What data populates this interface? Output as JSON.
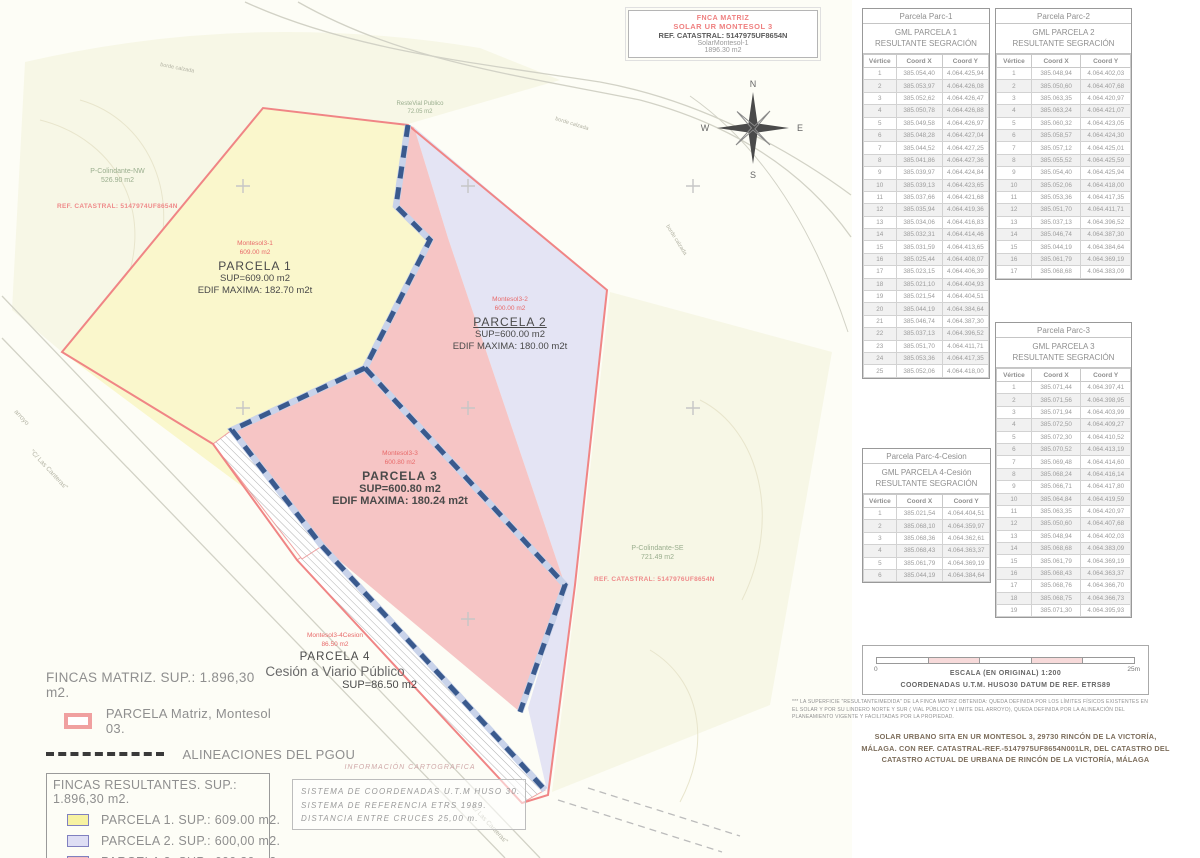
{
  "title_block": {
    "line1": "FNCA MATRIZ",
    "line2": "SOLAR UR MONTESOL 3",
    "line3": "REF. CATASTRAL: 5147975UF8654N",
    "line4": "SolarMontesol-1",
    "line5": "1896.30 m2"
  },
  "compass": {
    "n": "N",
    "s": "S",
    "e": "E",
    "w": "W"
  },
  "map_labels": {
    "colindante_nw": {
      "name": "P-Colindante-NW",
      "area": "526.90 m2",
      "ref": "REF. CATASTRAL: 5147974UF8654N"
    },
    "colindante_se": {
      "name": "P-Colindante-SE",
      "area": "721.49 m2",
      "ref": "REF. CATASTRAL: 5147976UF8654N"
    },
    "reste_vial": {
      "name": "ResteVial Publico",
      "area": "72.05 m2"
    },
    "parcela1": {
      "tag": "Montesol3-1",
      "tag_area": "609.00 m2",
      "title": "PARCELA 1",
      "sup": "SUP=609.00 m2",
      "edif": "EDIF MAXIMA: 182.70 m2t"
    },
    "parcela2": {
      "tag": "Montesol3-2",
      "tag_area": "600.00 m2",
      "title": "PARCELA 2",
      "sup": "SUP=600.00 m2",
      "edif": "EDIF MAXIMA: 180.00 m2t"
    },
    "parcela3": {
      "tag": "Montesol3-3",
      "tag_area": "600.80 m2",
      "title": "PARCELA 3",
      "sup": "SUP=600.80 m2",
      "edif": "EDIF MAXIMA: 180.24 m2t"
    },
    "parcela4": {
      "tag": "Montesol3-4Cesion",
      "tag_area": "86.50 m2",
      "title": "PARCELA 4",
      "subtitle": "Cesión a Viario Público",
      "sup": "SUP=86.50 m2"
    },
    "street_canteras": "\"C/ Las Canteras\"",
    "street_arroyo": "arroyo",
    "road_edge": "borde calzada"
  },
  "legend": {
    "fincas_matriz": "FINCAS MATRIZ.  SUP.: 1.896,30 m2.",
    "parcela_matriz": "PARCELA Matriz, Montesol 03.",
    "alineaciones": "ALINEACIONES DEL PGOU",
    "fincas_resultantes": "FINCAS RESULTANTES. SUP.: 1.896,30 m2.",
    "items": [
      {
        "label": "PARCELA 1. SUP.: 609.00 m2.",
        "color": "#f7f2a2"
      },
      {
        "label": "PARCELA 2. SUP.: 600,00 m2.",
        "color": "#dedef4"
      },
      {
        "label": "PARCELA 3. SUP.: 600,80 m2.",
        "color": "#f3bcbc"
      },
      {
        "label": "CESION VIARIO. SUP.: 86.50 m2.",
        "color": "#ffffff"
      }
    ]
  },
  "cartografia": {
    "header": "INFORMACIÓN CARTOGRAFICA",
    "lines": [
      "SISTEMA DE COORDENADAS U.T.M HUSO 30.",
      "SISTEMA DE REFERENCIA ETRS 1989.",
      "DISTANCIA ENTRE CRUCES 25,00 m."
    ]
  },
  "tables": [
    {
      "title": "Parcela Parc-1",
      "subtitle1": "GML PARCELA 1",
      "subtitle2": "RESULTANTE SEGRACIÓN",
      "headers": [
        "Vértice",
        "Coord X",
        "Coord Y"
      ],
      "rows": [
        [
          "1",
          "385.054,40",
          "4.064.425,94"
        ],
        [
          "2",
          "385.053,97",
          "4.064.426,08"
        ],
        [
          "3",
          "385.052,62",
          "4.064.426,47"
        ],
        [
          "4",
          "385.050,78",
          "4.064.426,88"
        ],
        [
          "5",
          "385.049,58",
          "4.064.426,97"
        ],
        [
          "6",
          "385.048,28",
          "4.064.427,04"
        ],
        [
          "7",
          "385.044,52",
          "4.064.427,25"
        ],
        [
          "8",
          "385.041,86",
          "4.064.427,36"
        ],
        [
          "9",
          "385.039,97",
          "4.064.424,84"
        ],
        [
          "10",
          "385.039,13",
          "4.064.423,65"
        ],
        [
          "11",
          "385.037,66",
          "4.064.421,68"
        ],
        [
          "12",
          "385.035,94",
          "4.064.419,36"
        ],
        [
          "13",
          "385.034,06",
          "4.064.416,83"
        ],
        [
          "14",
          "385.032,31",
          "4.064.414,46"
        ],
        [
          "15",
          "385.031,59",
          "4.064.413,65"
        ],
        [
          "16",
          "385.025,44",
          "4.064.408,07"
        ],
        [
          "17",
          "385.023,15",
          "4.064.406,39"
        ],
        [
          "18",
          "385.021,10",
          "4.064.404,93"
        ],
        [
          "19",
          "385.021,54",
          "4.064.404,51"
        ],
        [
          "20",
          "385.044,19",
          "4.064.384,64"
        ],
        [
          "21",
          "385.046,74",
          "4.064.387,30"
        ],
        [
          "22",
          "385.037,13",
          "4.064.396,52"
        ],
        [
          "23",
          "385.051,70",
          "4.064.411,71"
        ],
        [
          "24",
          "385.053,36",
          "4.064.417,35"
        ],
        [
          "25",
          "385.052,06",
          "4.064.418,00"
        ]
      ]
    },
    {
      "title": "Parcela Parc-2",
      "subtitle1": "GML PARCELA 2",
      "subtitle2": "RESULTANTE SEGRACIÓN",
      "headers": [
        "Vértice",
        "Coord X",
        "Coord Y"
      ],
      "rows": [
        [
          "1",
          "385.048,94",
          "4.064.402,03"
        ],
        [
          "2",
          "385.050,60",
          "4.064.407,68"
        ],
        [
          "3",
          "385.063,35",
          "4.064.420,97"
        ],
        [
          "4",
          "385.063,24",
          "4.064.421,07"
        ],
        [
          "5",
          "385.060,32",
          "4.064.423,05"
        ],
        [
          "6",
          "385.058,57",
          "4.064.424,30"
        ],
        [
          "7",
          "385.057,12",
          "4.064.425,01"
        ],
        [
          "8",
          "385.055,52",
          "4.064.425,59"
        ],
        [
          "9",
          "385.054,40",
          "4.064.425,94"
        ],
        [
          "10",
          "385.052,06",
          "4.064.418,00"
        ],
        [
          "11",
          "385.053,36",
          "4.064.417,35"
        ],
        [
          "12",
          "385.051,70",
          "4.064.411,71"
        ],
        [
          "13",
          "385.037,13",
          "4.064.396,52"
        ],
        [
          "14",
          "385.046,74",
          "4.064.387,30"
        ],
        [
          "15",
          "385.044,19",
          "4.064.384,64"
        ],
        [
          "16",
          "385.061,79",
          "4.064.369,19"
        ],
        [
          "17",
          "385.068,68",
          "4.064.383,09"
        ]
      ]
    },
    {
      "title": "Parcela Parc-3",
      "subtitle1": "GML PARCELA 3",
      "subtitle2": "RESULTANTE SEGRACIÓN",
      "headers": [
        "Vértice",
        "Coord X",
        "Coord Y"
      ],
      "rows": [
        [
          "1",
          "385.071,44",
          "4.064.397,41"
        ],
        [
          "2",
          "385.071,56",
          "4.064.398,95"
        ],
        [
          "3",
          "385.071,94",
          "4.064.403,99"
        ],
        [
          "4",
          "385.072,50",
          "4.064.409,27"
        ],
        [
          "5",
          "385.072,30",
          "4.064.410,52"
        ],
        [
          "6",
          "385.070,52",
          "4.064.413,19"
        ],
        [
          "7",
          "385.069,48",
          "4.064.414,60"
        ],
        [
          "8",
          "385.068,24",
          "4.064.416,14"
        ],
        [
          "9",
          "385.066,71",
          "4.064.417,80"
        ],
        [
          "10",
          "385.064,84",
          "4.064.419,59"
        ],
        [
          "11",
          "385.063,35",
          "4.064.420,97"
        ],
        [
          "12",
          "385.050,60",
          "4.064.407,68"
        ],
        [
          "13",
          "385.048,94",
          "4.064.402,03"
        ],
        [
          "14",
          "385.068,68",
          "4.064.383,09"
        ],
        [
          "15",
          "385.061,79",
          "4.064.369,19"
        ],
        [
          "16",
          "385.068,43",
          "4.064.363,37"
        ],
        [
          "17",
          "385.068,76",
          "4.064.366,70"
        ],
        [
          "18",
          "385.068,75",
          "4.064.366,73"
        ],
        [
          "19",
          "385.071,30",
          "4.064.395,93"
        ]
      ]
    },
    {
      "title": "Parcela Parc-4-Cesion",
      "subtitle1": "GML PARCELA  4-Cesión",
      "subtitle2": "RESULTANTE SEGRACIÓN",
      "headers": [
        "Vértice",
        "Coord X",
        "Coord Y"
      ],
      "rows": [
        [
          "1",
          "385.021,54",
          "4.064.404,51"
        ],
        [
          "2",
          "385.068,10",
          "4.064.359,97"
        ],
        [
          "3",
          "385.068,36",
          "4.064.362,61"
        ],
        [
          "4",
          "385.068,43",
          "4.064.363,37"
        ],
        [
          "5",
          "385.061,79",
          "4.064.369,19"
        ],
        [
          "6",
          "385.044,19",
          "4.064.384,64"
        ]
      ]
    }
  ],
  "scale": {
    "zero": "0",
    "max": "25m",
    "line1": "ESCALA (EN ORIGINAL) 1:200",
    "line2": "COORDENADAS U.T.M. HUSO30 DATUM DE REF. ETRS89"
  },
  "footnote_lines": [
    "*** LA SUPERFICIE \"RESULTANTE/MEDIDA\" DE LA FINCA MATRIZ OBTENIDA: QUEDA DEFINIDA POR LOS LÍMITES FÍSICOS  EXISTENTES EN",
    "EL SOLAR Y POR SU LINDERO NORTE Y SUR ( VIAL PÚBLICO Y LIMITE DEL ARROYO), QUEDA DEFINIDA POR  LA ALINEACIÓN DEL",
    "PLANEAMIENTO VIGENTE Y FACILITADAS POR LA PROPIEDAD."
  ],
  "address_lines": [
    "SOLAR URBANO SITA EN UR MONTESOL 3, 29730 RINCÓN DE LA VICTORÍA,",
    "MÁLAGA. CON REF. CATASTRAL-REF.-5147975UF8654N001LR, DEL CATASTRO DEL",
    "CATASTRO ACTUAL DE URBANA DE RINCÓN DE LA VICTORÍA, MÁLAGA"
  ],
  "colors": {
    "parcel1_fill": "#faf7cc",
    "parcel2_fill": "#e4e4f4",
    "parcel3_fill": "#f5c0c0",
    "matriz_line": "#f08585",
    "alignment_dash": "#3a5a8e",
    "colindante_fill": "#f7f7e6",
    "green_label": "#9aae8e",
    "red_label": "#e86a6a"
  }
}
